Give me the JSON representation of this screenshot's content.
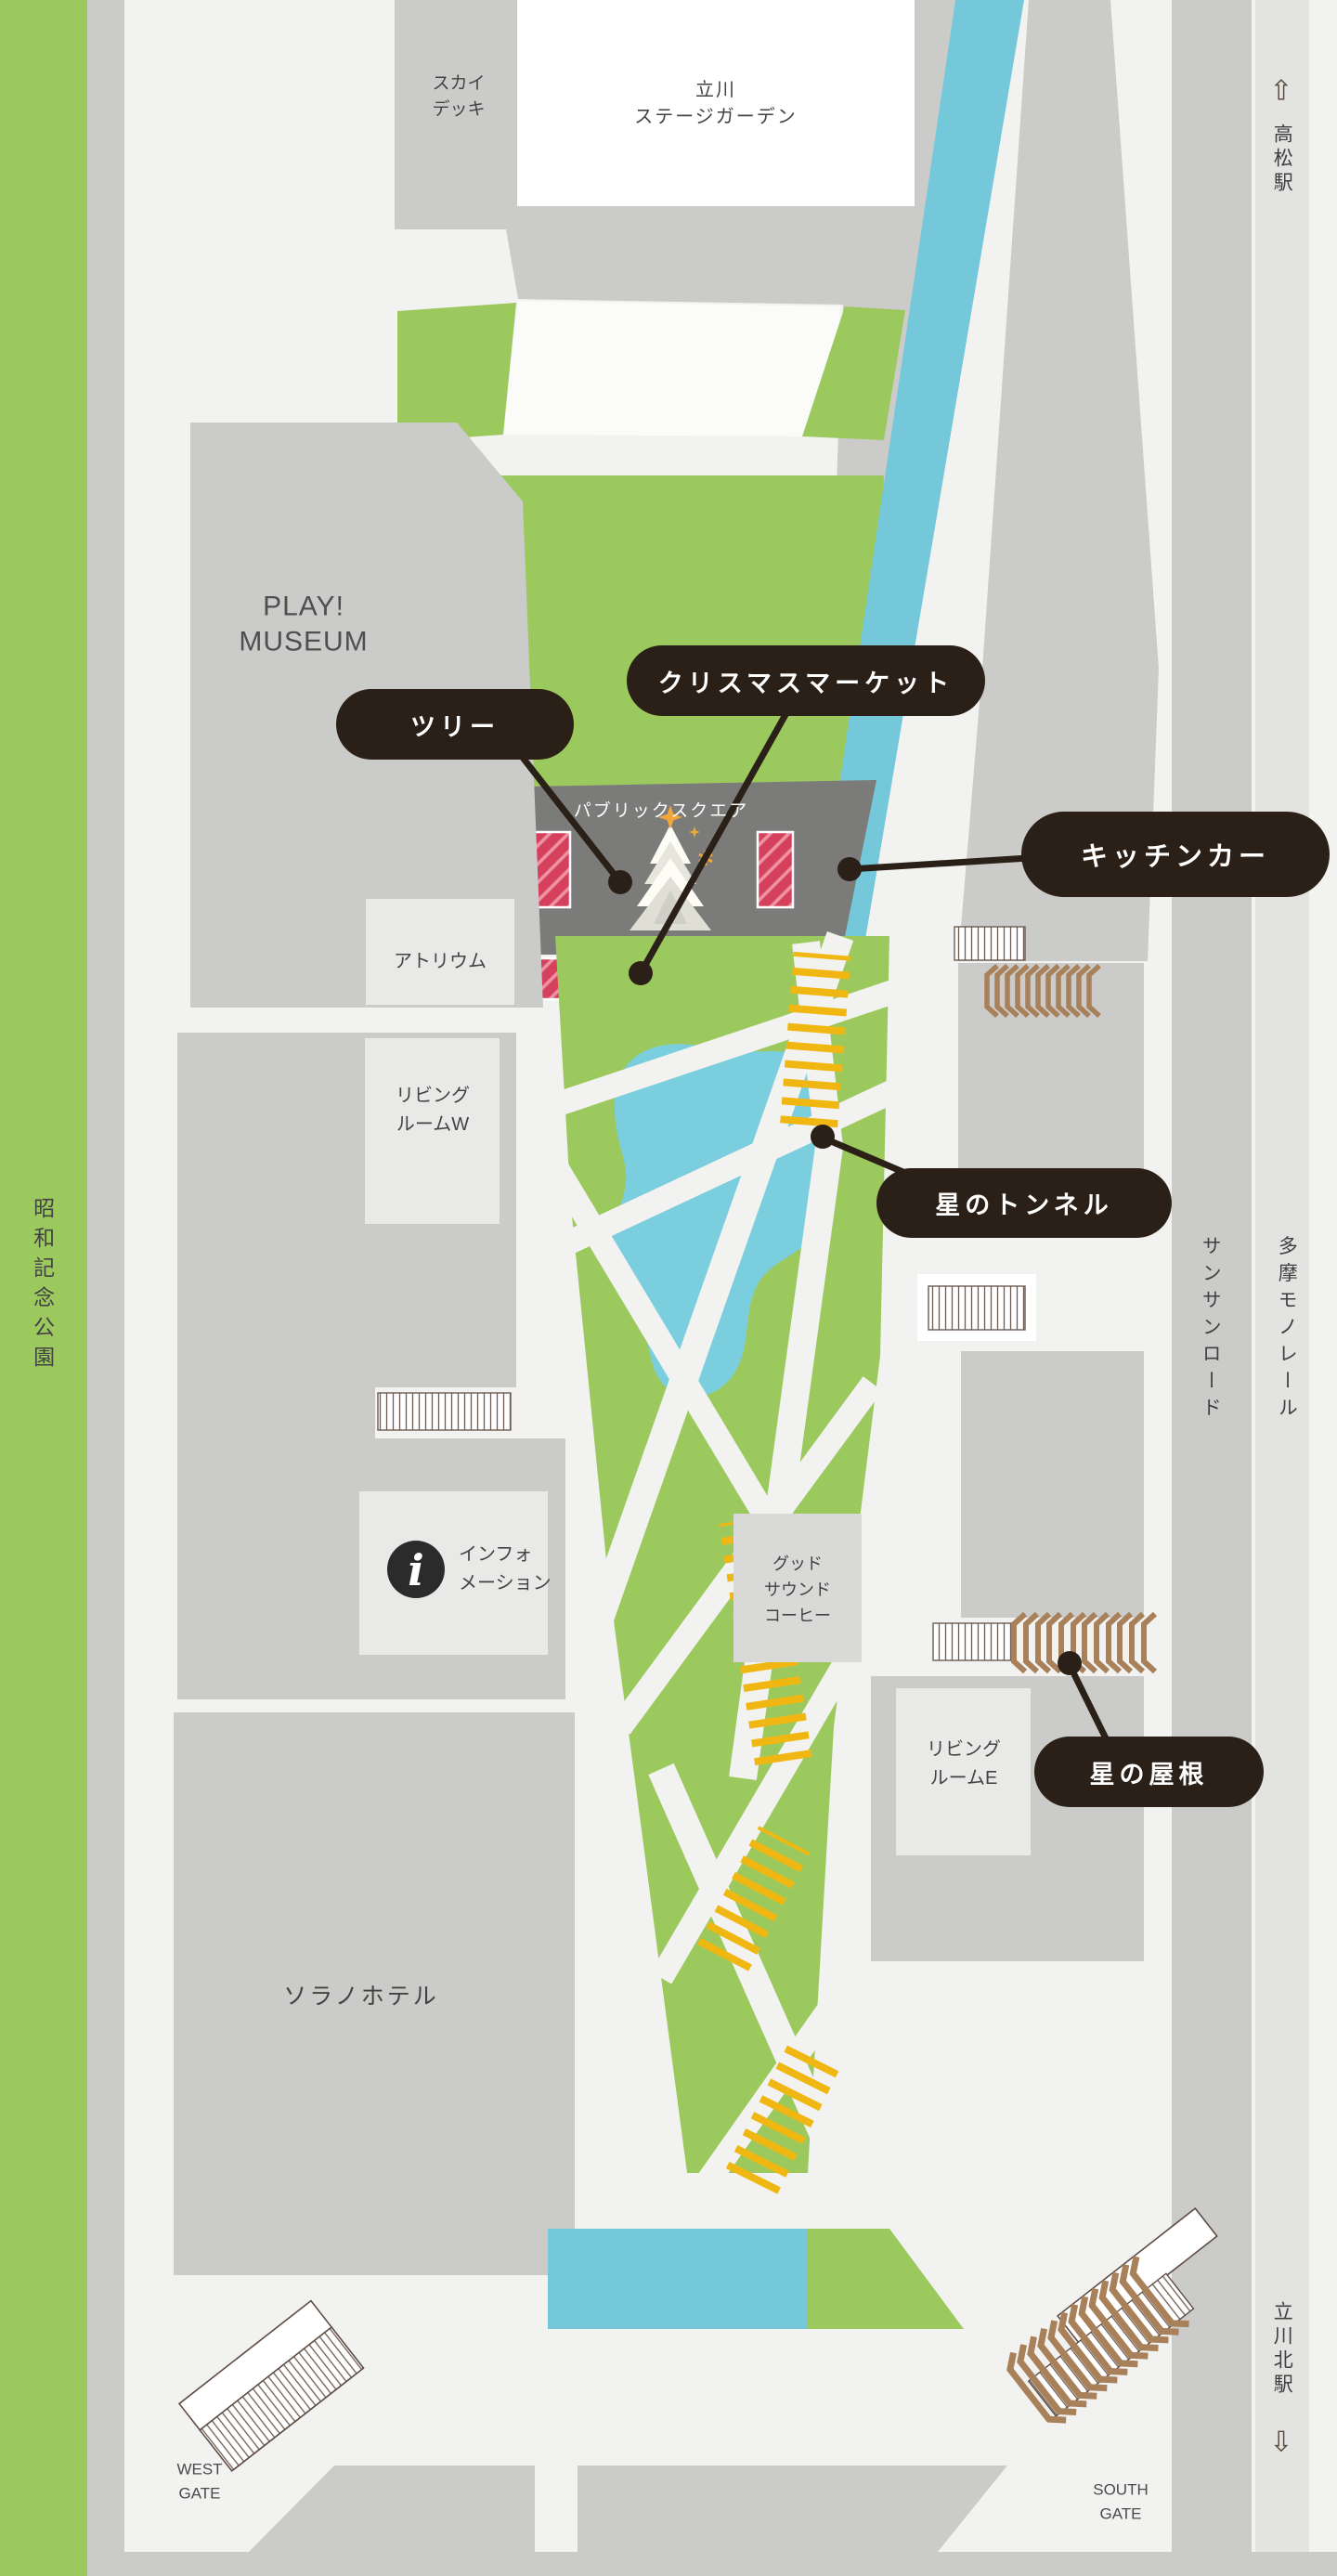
{
  "map": {
    "palette": {
      "background": "#f2f2f1",
      "park_green": "#9cc95e",
      "road_gray": "#cbcbca",
      "inner_box_gray": "#e9e9e8",
      "plaza_dark_gray": "#7b7b7a",
      "water_cyan": "#74c8da",
      "pond_blue": "#7bcede",
      "market_red": "#d5405c",
      "ladder_yellow": "#f0b713",
      "roof_brown": "#a8805a",
      "pill_dark": "#2b2018",
      "text_gray": "#434343"
    },
    "places": {
      "showa_kinen_park": "昭和記念公園",
      "sky_deck": [
        "スカイ",
        "デッキ"
      ],
      "stage_garden": [
        "立川",
        "ステージガーデン"
      ],
      "play_museum": [
        "PLAY!",
        "MUSEUM"
      ],
      "atrium": "アトリウム",
      "public_square": "パブリックスクエア",
      "living_room_w": [
        "リビング",
        "ルームW"
      ],
      "living_room_e": [
        "リビング",
        "ルームE"
      ],
      "information": [
        "インフォ",
        "メーション"
      ],
      "good_sound_coffee": [
        "グッド",
        "サウンド",
        "コーヒー"
      ],
      "sorano_hotel": "ソラノホテル",
      "sunsun_road": "サンサンロード",
      "tama_monorail": "多摩モノレール"
    },
    "stations": {
      "takamatsu": {
        "name": "高松駅",
        "arrow": "⇧"
      },
      "tachikawa_kita": {
        "name": "立川北駅",
        "arrow": "⇩"
      }
    },
    "gates": {
      "west": [
        "WEST",
        "GATE"
      ],
      "south": [
        "SOUTH",
        "GATE"
      ]
    },
    "callouts": {
      "tree": "ツリー",
      "christmas_market": "クリスマスマーケット",
      "kitchen_car": "キッチンカー",
      "star_tunnel": "星のトンネル",
      "star_roof": "星の屋根"
    },
    "icons": {
      "information": "i"
    }
  }
}
